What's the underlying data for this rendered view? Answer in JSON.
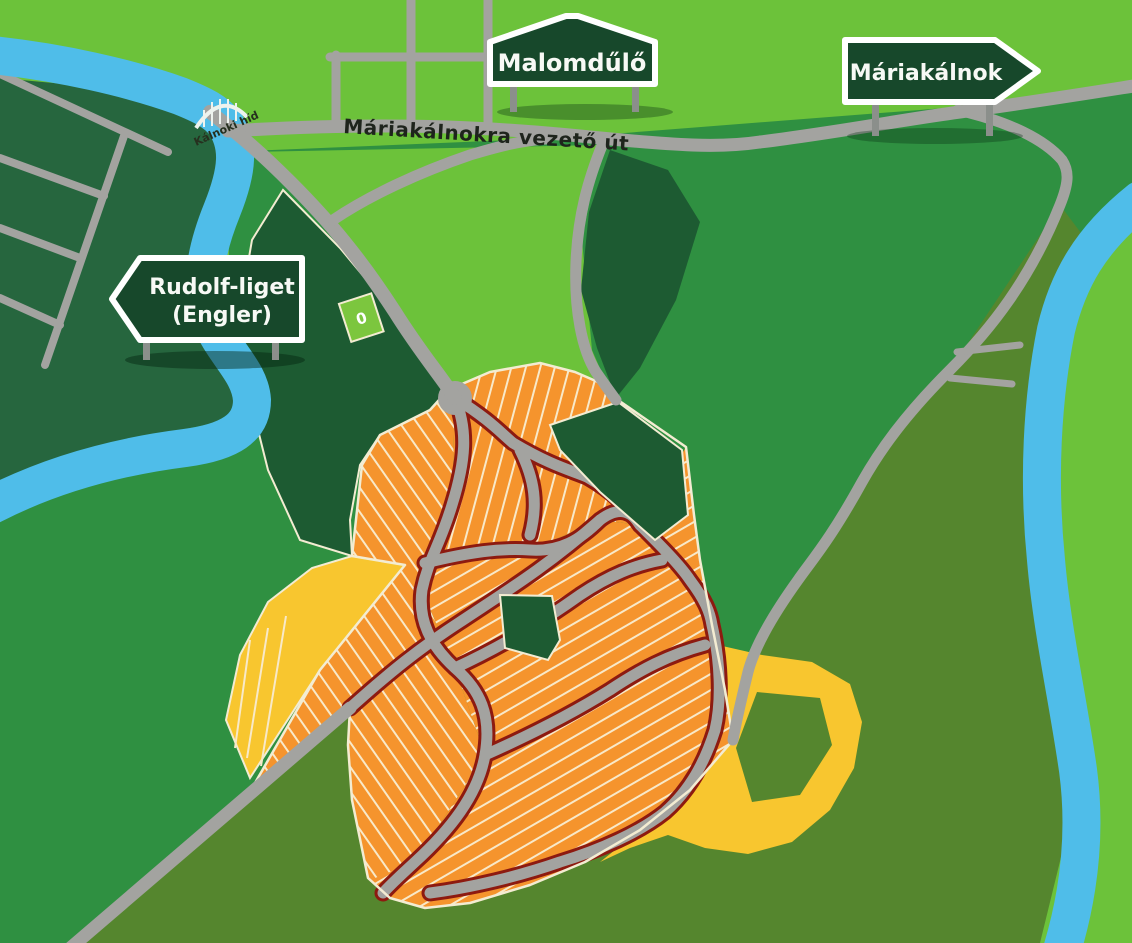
{
  "map": {
    "title": "settlement development illustrated map",
    "signs": {
      "malomdulo": {
        "label": "Malomdűlő"
      },
      "mariakalnok": {
        "label": "Máriakálnok"
      },
      "rudolf": {
        "line1": "Rudolf-liget",
        "line2": "(Engler)"
      }
    },
    "road_label": "Máriakálnokra vezető út",
    "bridge_label": "Kálnoki híd",
    "plot_label": "0",
    "colors": {
      "bright_green": "#6cc23a",
      "medium_green": "#2f9041",
      "olive_green": "#55862e",
      "dark_green": "#1d5b32",
      "dark_field_green": "#26663e",
      "river_blue": "#4fbde9",
      "road_gray": "#a3a3a0",
      "parcel_orange": "#f5942d",
      "parcel_line_cream": "#f8e9c9",
      "frontage_dark_red": "#8d1a10",
      "field_yellow": "#f8c62f",
      "sign_green": "#17482b",
      "sign_border": "#ffffff"
    }
  }
}
